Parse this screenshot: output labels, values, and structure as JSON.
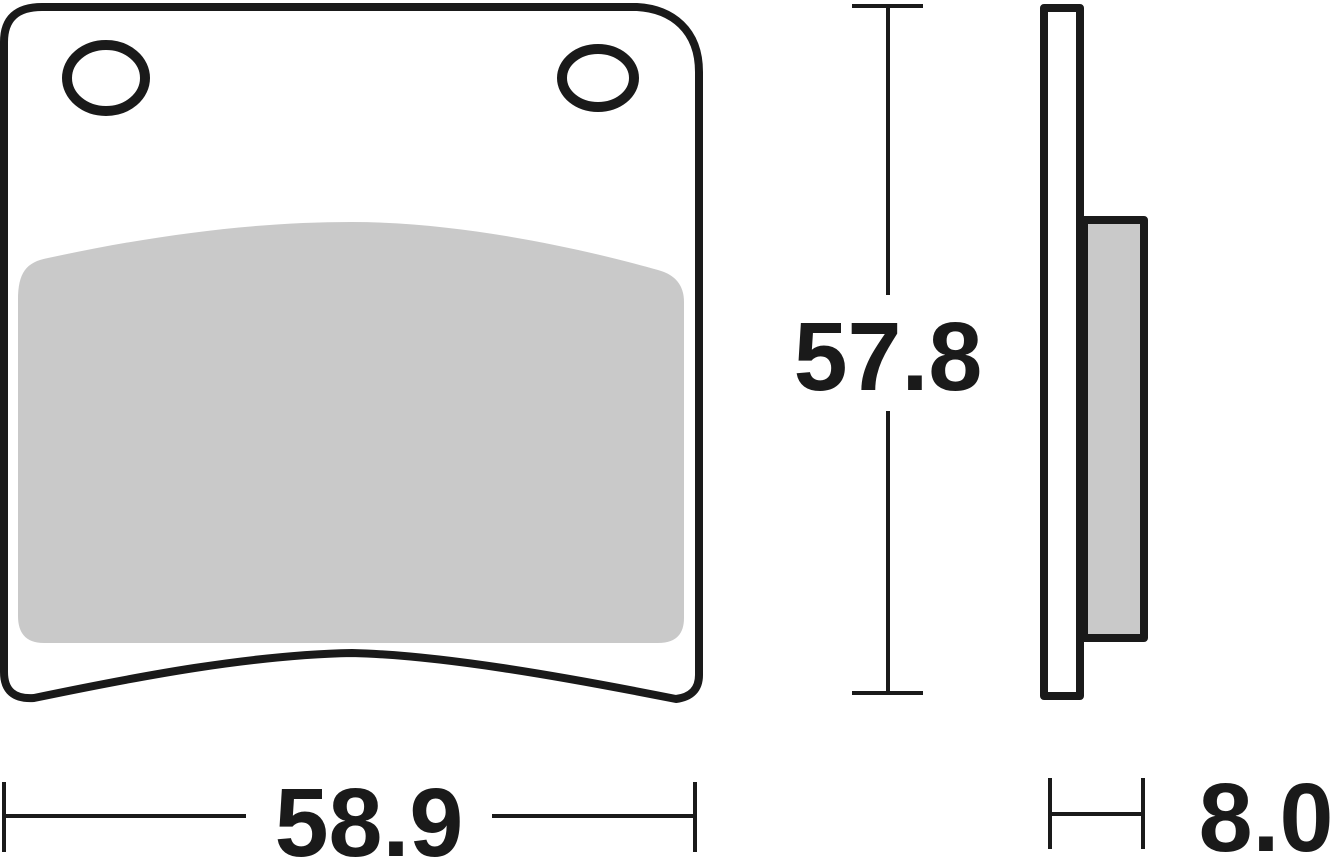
{
  "dimensions": {
    "width": "58.9",
    "height": "57.8",
    "thickness": "8.0"
  },
  "colors": {
    "line": "#1a1a1a",
    "pad_material": "#c9c9c9",
    "background": "#ffffff"
  }
}
